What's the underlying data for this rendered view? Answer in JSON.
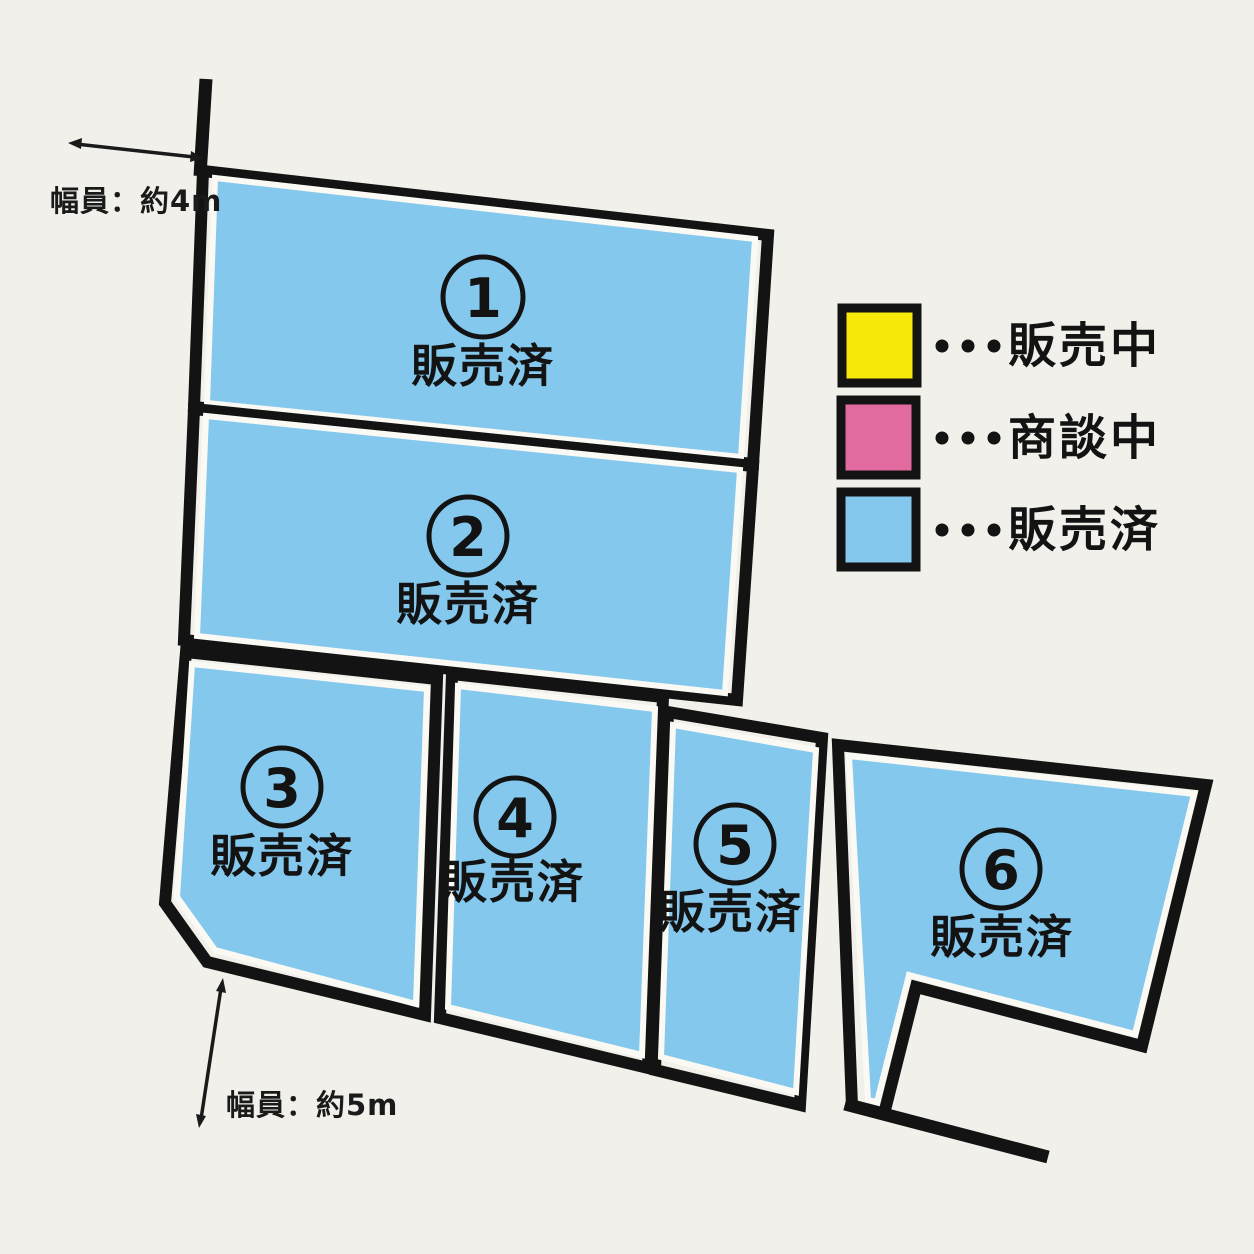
{
  "colors": {
    "background": "#f2f0ea",
    "outline": "#131313",
    "gap_white": "#fbf9f3",
    "sold_fill": "#84c9ed",
    "on_sale_fill": "#f6e90a",
    "negotiating_fill": "#e16a9e"
  },
  "legend": {
    "separator": "・・・",
    "items": [
      {
        "key": "on-sale",
        "label": "販売中",
        "color": "#f6e90a"
      },
      {
        "key": "negotiating",
        "label": "商談中",
        "color": "#e16a9e"
      },
      {
        "key": "sold",
        "label": "販売済",
        "color": "#84c9ed"
      }
    ]
  },
  "lots": [
    {
      "number": "1",
      "status": "販売済"
    },
    {
      "number": "2",
      "status": "販売済"
    },
    {
      "number": "3",
      "status": "販売済"
    },
    {
      "number": "4",
      "status": "販売済"
    },
    {
      "number": "5",
      "status": "販売済"
    },
    {
      "number": "6",
      "status": "販売済"
    }
  ],
  "annotations": {
    "road_width_top": "幅員：約4m",
    "road_width_bottom": "幅員：約5m"
  }
}
